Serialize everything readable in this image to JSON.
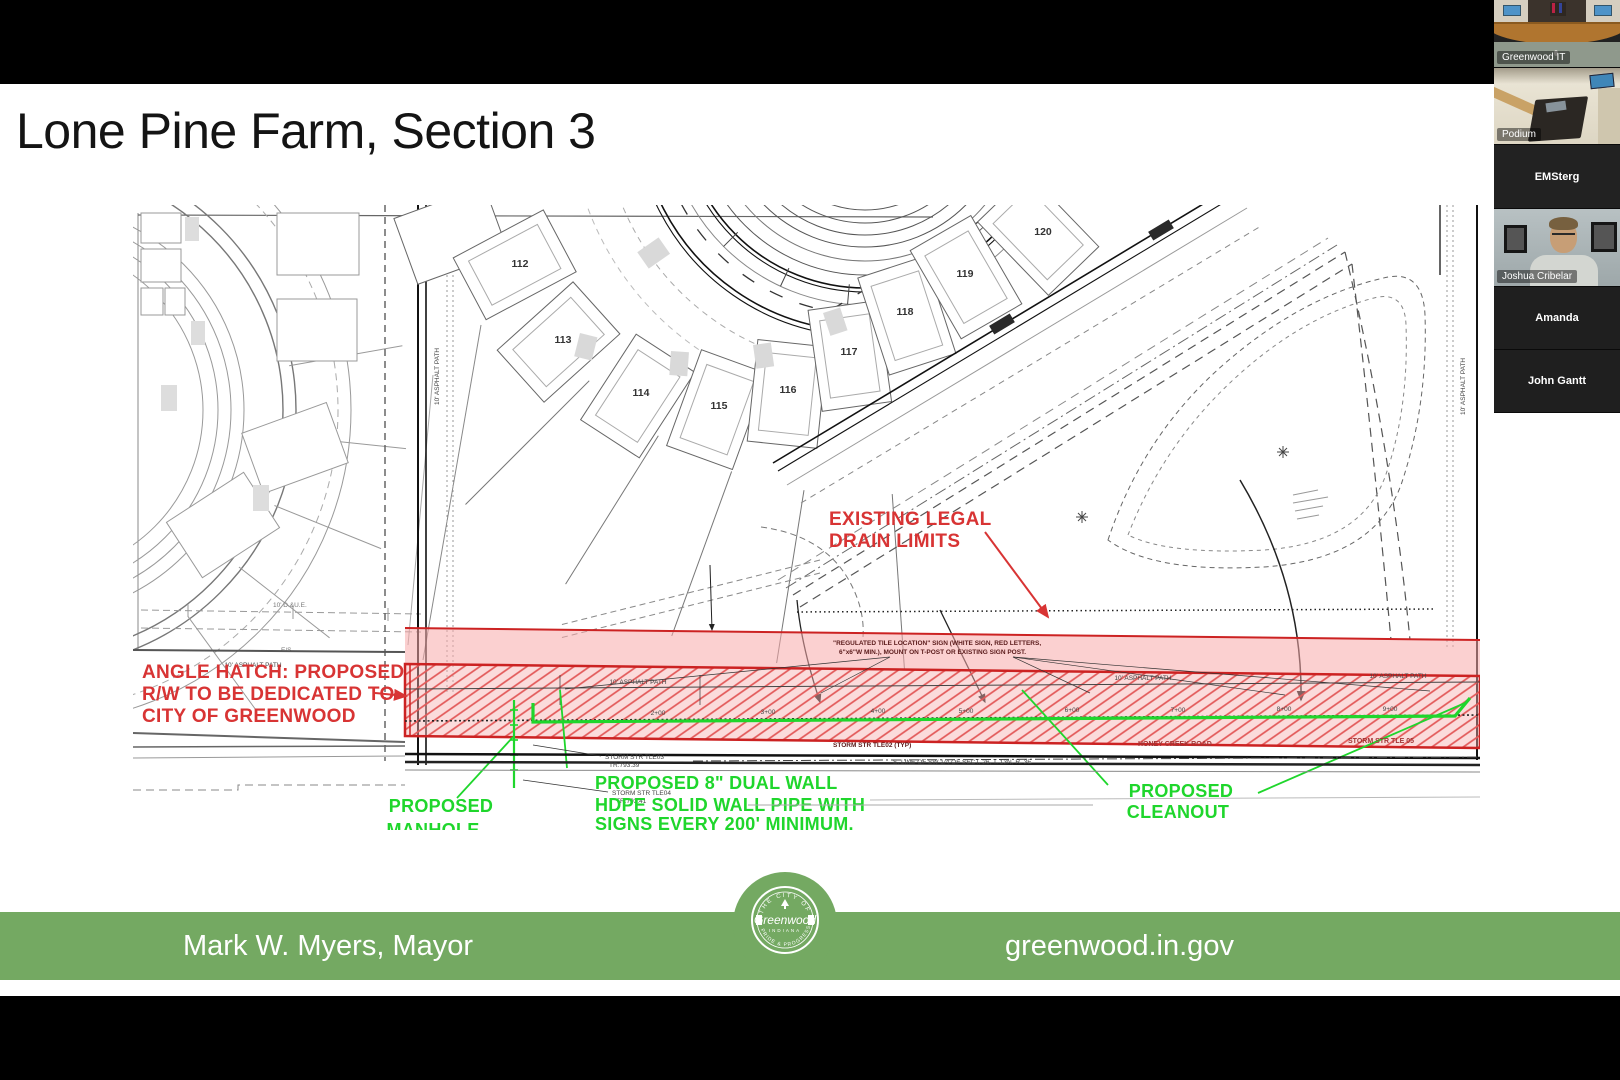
{
  "slide": {
    "title": "Lone Pine Farm, Section 3",
    "footer": {
      "mayor": "Mark W. Myers, Mayor",
      "website": "greenwood.in.gov",
      "logo": {
        "top": "THE CITY OF",
        "name": "Greenwood",
        "middle": "INDIANA",
        "bottom": "PRIDE & PROGRESS"
      }
    }
  },
  "plat": {
    "lots": [
      "112",
      "113",
      "114",
      "115",
      "116",
      "117",
      "118",
      "119",
      "120"
    ],
    "annotations": {
      "red": {
        "drain_limits": [
          "EXISTING LEGAL",
          "DRAIN LIMITS"
        ],
        "angle_hatch": [
          "ANGLE HATCH: PROPOSED",
          "R/W TO BE DEDICATED TO",
          "CITY OF GREENWOOD"
        ]
      },
      "green": {
        "manhole": [
          "PROPOSED",
          "MANHOLE"
        ],
        "pipe": [
          "PROPOSED 8\" DUAL WALL",
          "HDPE SOLID WALL PIPE WITH",
          "SIGNS EVERY 200' MINIMUM."
        ],
        "cleanout": [
          "PROPOSED",
          "CLEANOUT"
        ]
      }
    },
    "micro": {
      "stations": [
        "2+00",
        "3+00",
        "4+00",
        "5+00",
        "6+00",
        "7+00",
        "8+00",
        "9+00"
      ],
      "asphalt_path": "10' ASPHALT PATH",
      "due": "10' D.&U.E.",
      "es": "E/S",
      "sign_line1": "\"REGULATED TILE LOCATION\" SIGN (WHITE SIGN, RED LETTERS,",
      "sign_line2": "6\"x6\"W MIN.), MOUNT ON T-POST OR EXISTING SIGN POST.",
      "storm03a": "STORM STR TLE03",
      "storm03b": "TR:793.39",
      "storm04a": "STORM STR TLE04",
      "storm04b": "TR:793.41",
      "storm02": "STORM STR TLE02 (TYP)",
      "storm05": "STORM STR TLE 05",
      "honey_creek": "HONEY CREEK ROAD",
      "section_line": "S. LINE OF SW 1/4 OF SECT. 26, T. 13N, R. 3E"
    },
    "colors": {
      "annotation_red": "#d83434",
      "annotation_green": "#1fd62c",
      "hatch_pink": "#e25858",
      "footer_green": "#74a962"
    }
  },
  "participants": [
    {
      "name": "Greenwood IT"
    },
    {
      "name": "Podium"
    },
    {
      "name": "EMSterg"
    },
    {
      "name": "Joshua Cribelar"
    },
    {
      "name": "Amanda"
    },
    {
      "name": "John Gantt"
    }
  ]
}
